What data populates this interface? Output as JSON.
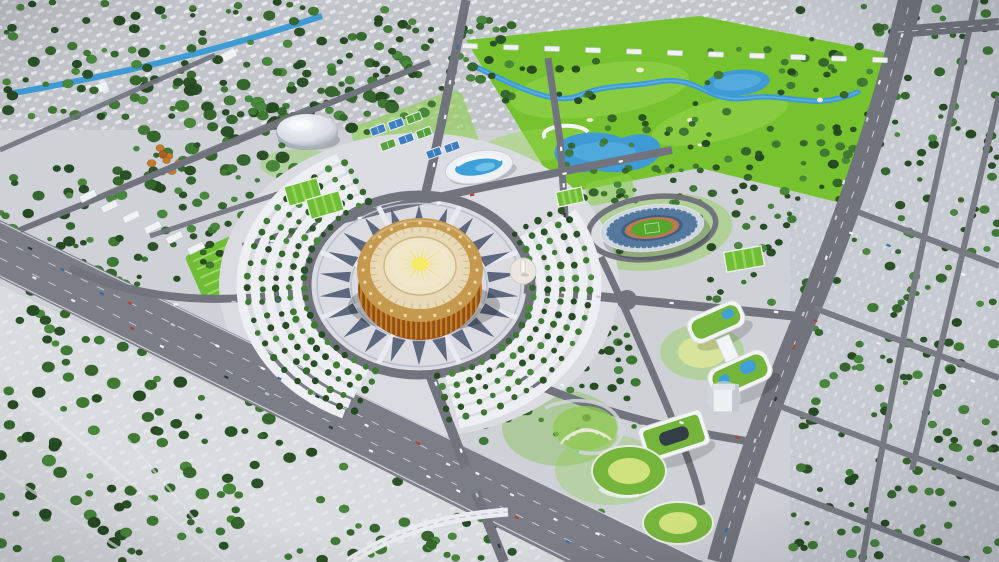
{
  "meta": {
    "title": "Aerial masterplan render",
    "alt": "Aerial 3D rendering of an urban sports-park masterplan: a golden circular ceremonial arena on a patterned plaza with radial tree fans, a national stadium, golf course with river and ponds, indoor arena, aquatic center, tennis courts, eco office buildings with green roofs, wide highways and tree-filled city blocks."
  },
  "landmarks": [
    {
      "id": "golden-arena",
      "label": "Golden circular ceremonial arena with sunburst roof"
    },
    {
      "id": "ceremonial-plaza",
      "label": "Patterned ceremonial plaza with radial ornament"
    },
    {
      "id": "tree-fans",
      "label": "Concentric fan rows of trees and parking arcs"
    },
    {
      "id": "stadium",
      "label": "Oval national stadium with green pitch"
    },
    {
      "id": "golf-course",
      "label": "Golf course with winding river and ponds"
    },
    {
      "id": "indoor-arena",
      "label": "White domed indoor arena"
    },
    {
      "id": "aquatic-center",
      "label": "Aquatic center with blue rooftop pool strip"
    },
    {
      "id": "tennis-courts",
      "label": "Cluster of blue and green tennis courts"
    },
    {
      "id": "football-fields",
      "label": "Bright green football training fields"
    },
    {
      "id": "parade-garden",
      "label": "Striped garden parterre block"
    },
    {
      "id": "monument-plaza",
      "label": "Small monument plaza"
    },
    {
      "id": "amphitheater-park",
      "label": "Terraced amphitheater park"
    },
    {
      "id": "eco-buildings",
      "label": "Curved white offices with green roofs and pools"
    },
    {
      "id": "highway",
      "label": "Wide diagonal highway"
    },
    {
      "id": "avenue",
      "label": "Curved eastern avenue"
    },
    {
      "id": "city-grid",
      "label": "Tree-filled city blocks grid"
    },
    {
      "id": "canal",
      "label": "Blue canal crossing the old town"
    },
    {
      "id": "forest",
      "label": "Scattered forest over old district"
    }
  ],
  "palette": {
    "base": "#ced2d7",
    "north": "#c2c6cb",
    "right": "#c6cbd1",
    "sw": "#d9dcdf",
    "road": "#71747d",
    "roadLight": "#7b7e87",
    "edge": "#f2f3f5",
    "plaza": "#dadce2",
    "ornament": "#4b5870",
    "ringLine": "#b9bfcc",
    "walk": "#e9ebf0",
    "parkArc": "#edeff3",
    "golf": "#76c32f",
    "golfLight": "#97d84f",
    "lawn": "#8ccf4a",
    "lawnDeep": "#6fbe35",
    "lawnRow": "#a8dd6f",
    "water": "#3f9bd3",
    "waterLight": "#7cc8ec",
    "treeA": "#2b5226",
    "treeB": "#35662c",
    "treeC": "#3f7a33",
    "treeD": "#264a22",
    "treeE": "#47883b",
    "orangeA": "#c57a2c",
    "orangeB": "#b05f22",
    "goldRim": "#c69a4e",
    "goldFace": "#e8dab6",
    "goldInner": "#efe5c6",
    "goldPale": "#f1e8cb",
    "goldTick": "#c9b183",
    "goldDot": "#f0e2ba",
    "sun": "#f2e243",
    "sunCore": "#f6ea69",
    "colA": "#cd7b25",
    "colB": "#8a5418",
    "redBand": "#b04a14",
    "white": "#f4f6f8",
    "steel": "#55799e",
    "steelDark": "#3f5f84",
    "stadiumRim": "#cdd5de",
    "track": "#b97a52",
    "pitch": "#55a82c",
    "roofGreen": "#76b53c",
    "lawnYellow": "#d7e49a",
    "courtBlue": "#3e7ec0",
    "courtGreen": "#55a23c",
    "carColors": [
      "#f5f7f9",
      "#eef0f3",
      "#2f353d",
      "#3a68a8",
      "#c2c7ce",
      "#b8412f",
      "#f5f7f9",
      "#e6e9ed"
    ]
  },
  "scene": {
    "arena": {
      "cx": 420,
      "cy": 276,
      "dots": 24,
      "ticks": 36,
      "sunRays": 18
    },
    "ornament": {
      "cx": 419,
      "cy": 285,
      "ky": 0.8,
      "count": 22,
      "r1": 70,
      "r2": 100,
      "halfDeg": 5.5
    },
    "walkways": {
      "count": 8,
      "r1": 64,
      "r2": 106,
      "startDeg": 22.5
    },
    "fans": {
      "cx": 419,
      "cy": 285,
      "ky": 0.8,
      "parkingRows": [
        122,
        136,
        150,
        164,
        178
      ],
      "treeRows": [
        115,
        129,
        143,
        157,
        171
      ],
      "spans": [
        [
          112,
          246
        ],
        [
          -34,
          80
        ]
      ],
      "stepDeg": 6,
      "treeR": 2.7
    },
    "tree_clusters": [
      {
        "id": "north-city",
        "x": 0,
        "y": 0,
        "w": 470,
        "h": 118,
        "n": 120,
        "rmin": 2.5,
        "rmax": 6
      },
      {
        "id": "north-center",
        "x": 380,
        "y": 20,
        "w": 140,
        "h": 60,
        "n": 30,
        "rmin": 2.5,
        "rmax": 5.5
      },
      {
        "id": "nw-forest",
        "x": 135,
        "y": 58,
        "w": 260,
        "h": 130,
        "n": 110,
        "rmin": 3,
        "rmax": 7
      },
      {
        "id": "west-park",
        "x": 0,
        "y": 168,
        "w": 155,
        "h": 195,
        "n": 60,
        "rmin": 3,
        "rmax": 6.5
      },
      {
        "id": "parade-block",
        "x": 150,
        "y": 168,
        "w": 165,
        "h": 85,
        "n": 48,
        "rmin": 2.5,
        "rmax": 5.5
      },
      {
        "id": "golf-1",
        "x": 497,
        "y": 52,
        "w": 100,
        "h": 50,
        "n": 13,
        "rmin": 2.5,
        "rmax": 5
      },
      {
        "id": "golf-2",
        "x": 607,
        "y": 92,
        "w": 120,
        "h": 55,
        "n": 15,
        "rmin": 2.5,
        "rmax": 5
      },
      {
        "id": "golf-3",
        "x": 697,
        "y": 48,
        "w": 110,
        "h": 45,
        "n": 11,
        "rmin": 2.5,
        "rmax": 5
      },
      {
        "id": "golf-4",
        "x": 757,
        "y": 125,
        "w": 90,
        "h": 58,
        "n": 11,
        "rmin": 2.5,
        "rmax": 5
      },
      {
        "id": "golf-5",
        "x": 540,
        "y": 138,
        "w": 95,
        "h": 42,
        "n": 9,
        "rmin": 2,
        "rmax": 4.5
      },
      {
        "id": "right-grid",
        "x": 793,
        "y": 0,
        "w": 206,
        "h": 562,
        "n": 220,
        "rmin": 2.5,
        "rmax": 5.5
      },
      {
        "id": "sw-forest",
        "x": 0,
        "y": 358,
        "w": 430,
        "h": 204,
        "n": 140,
        "rmin": 3,
        "rmax": 7
      },
      {
        "id": "highway-row",
        "x": 30,
        "y": 232,
        "w": 400,
        "h": 52,
        "n": 36,
        "rmin": 2,
        "rmax": 4.5
      },
      {
        "id": "plaza-east",
        "x": 478,
        "y": 182,
        "w": 150,
        "h": 95,
        "n": 40,
        "rmin": 2.5,
        "rmax": 5
      },
      {
        "id": "se-park",
        "x": 468,
        "y": 328,
        "w": 190,
        "h": 128,
        "n": 55,
        "rmin": 2.5,
        "rmax": 5.5
      },
      {
        "id": "east-strip",
        "x": 698,
        "y": 148,
        "w": 100,
        "h": 158,
        "n": 36,
        "rmin": 2.5,
        "rmax": 5
      },
      {
        "id": "stadium-north",
        "x": 588,
        "y": 162,
        "w": 150,
        "h": 44,
        "n": 22,
        "rmin": 2,
        "rmax": 4
      },
      {
        "id": "bottom-center",
        "x": 418,
        "y": 478,
        "w": 185,
        "h": 82,
        "n": 30,
        "rmin": 2.5,
        "rmax": 5.5
      },
      {
        "id": "autumn",
        "x": 148,
        "y": 146,
        "w": 48,
        "h": 30,
        "n": 9,
        "rmin": 2.5,
        "rmax": 4.5,
        "autumn": true
      }
    ],
    "car_roads": [
      {
        "x1": 0,
        "y1": 238,
        "x2": 618,
        "y2": 548,
        "n": 16,
        "w": 9
      },
      {
        "x1": 0,
        "y1": 260,
        "x2": 588,
        "y2": 556,
        "n": 12,
        "w": 9
      },
      {
        "x1": 906,
        "y1": 15,
        "x2": 722,
        "y2": 550,
        "n": 12,
        "w": 12
      },
      {
        "x1": 528,
        "y1": 289,
        "x2": 792,
        "y2": 315,
        "n": 5,
        "w": 4
      },
      {
        "x1": 430,
        "y1": 374,
        "x2": 502,
        "y2": 556,
        "n": 4,
        "w": 4
      },
      {
        "x1": 500,
        "y1": 369,
        "x2": 756,
        "y2": 442,
        "n": 5,
        "w": 4
      },
      {
        "x1": 250,
        "y1": 244,
        "x2": 658,
        "y2": 153,
        "n": 6,
        "w": 4
      },
      {
        "x1": 426,
        "y1": 196,
        "x2": 466,
        "y2": 12,
        "n": 4,
        "w": 4
      },
      {
        "x1": 803,
        "y1": 213,
        "x2": 995,
        "y2": 287,
        "n": 3,
        "w": 3
      },
      {
        "x1": 786,
        "y1": 308,
        "x2": 995,
        "y2": 389,
        "n": 3,
        "w": 3
      },
      {
        "x1": 152,
        "y1": 306,
        "x2": 300,
        "y2": 300,
        "n": 3,
        "w": 3
      },
      {
        "x1": 560,
        "y1": 128,
        "x2": 566,
        "y2": 228,
        "n": 3,
        "w": 3
      }
    ],
    "courts": {
      "w": 15,
      "h": 8.5,
      "rot": -20,
      "items": [
        {
          "x": 378,
          "y": 130,
          "c": "blue"
        },
        {
          "x": 396,
          "y": 124,
          "c": "blue"
        },
        {
          "x": 414,
          "y": 118,
          "c": "green"
        },
        {
          "x": 388,
          "y": 145,
          "c": "green"
        },
        {
          "x": 406,
          "y": 139,
          "c": "blue"
        },
        {
          "x": 424,
          "y": 133,
          "c": "green"
        },
        {
          "x": 434,
          "y": 153,
          "c": "blue"
        },
        {
          "x": 452,
          "y": 147,
          "c": "blue"
        }
      ]
    },
    "fields": [
      {
        "x": 303,
        "y": 192,
        "w": 34,
        "h": 20,
        "rot": -16
      },
      {
        "x": 325,
        "y": 205,
        "w": 34,
        "h": 20,
        "rot": -16
      },
      {
        "x": 570,
        "y": 197,
        "w": 26,
        "h": 15,
        "rot": -12
      },
      {
        "x": 744,
        "y": 259,
        "w": 38,
        "h": 20,
        "rot": -10
      }
    ],
    "white_rows": [
      {
        "x1": 88,
        "y1": 196,
        "x2": 196,
        "y2": 248,
        "n": 6,
        "w": 17,
        "h": 7,
        "rot": -26
      },
      {
        "x1": 470,
        "y1": 46,
        "x2": 880,
        "y2": 60,
        "n": 11,
        "w": 15,
        "h": 5,
        "rot": 2
      }
    ]
  }
}
